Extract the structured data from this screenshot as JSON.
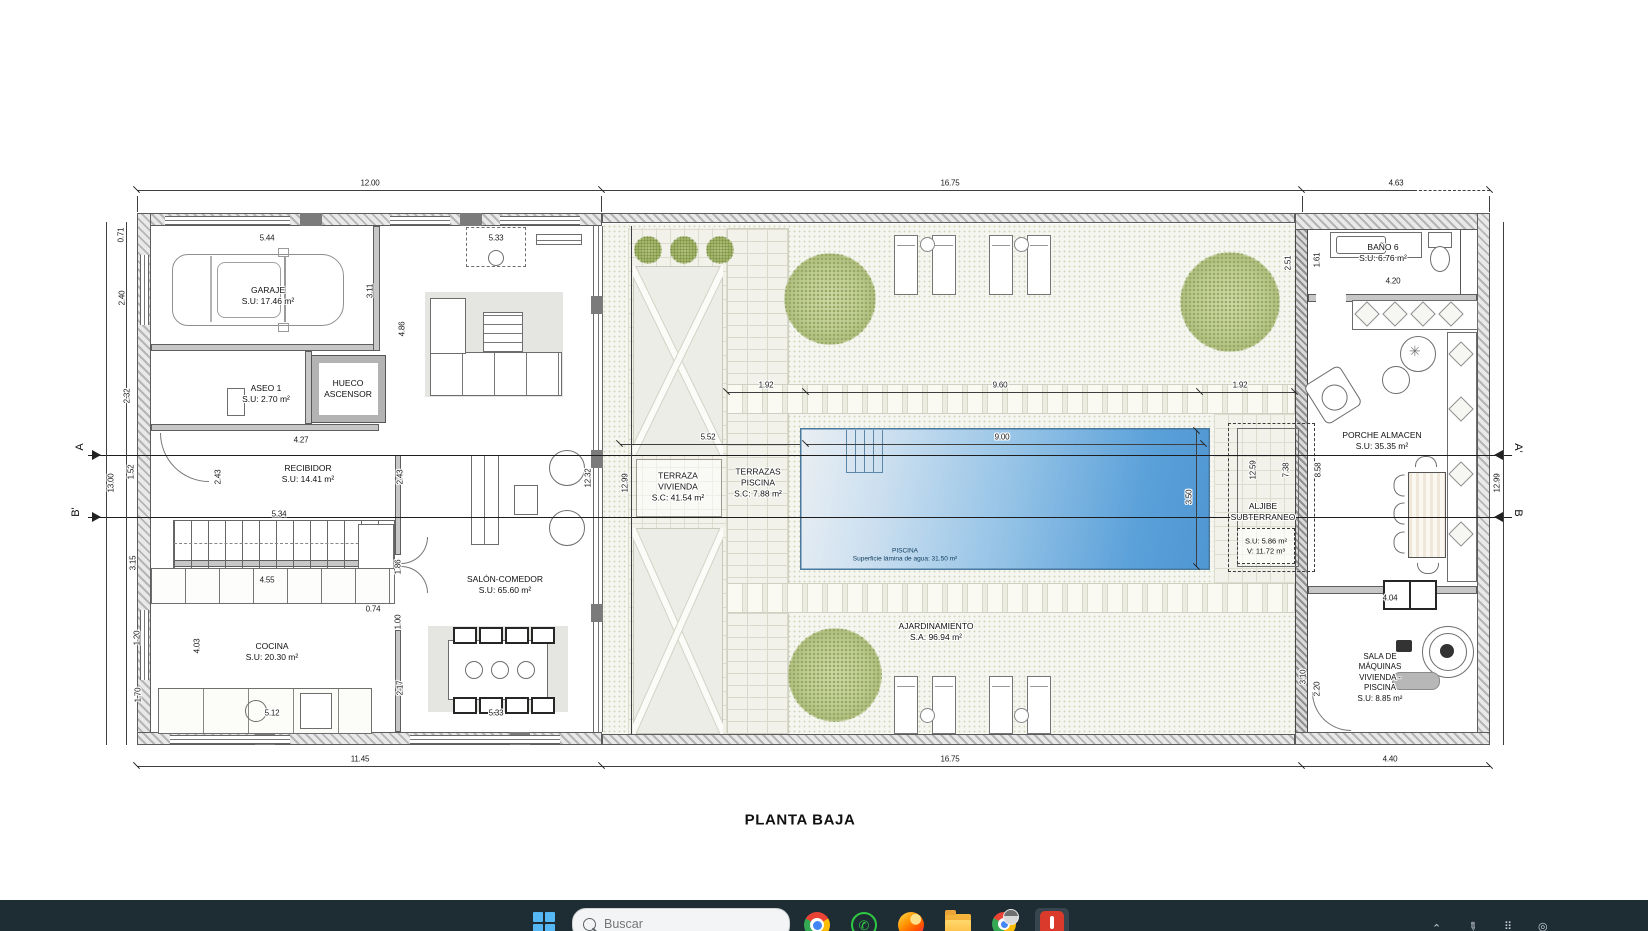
{
  "title": "PLANTA BAJA",
  "rooms": {
    "garaje": {
      "l1": "GARAJE",
      "l2": "S.U: 17.46 m²"
    },
    "aseo": {
      "l1": "ASEO 1",
      "l2": "S.U: 2.70 m²"
    },
    "hueco": {
      "l1": "HUECO",
      "l2": "ASCENSOR"
    },
    "recibidor": {
      "l1": "RECIBIDOR",
      "l2": "S.U: 14.41 m²"
    },
    "salon": {
      "l1": "SALÓN-COMEDOR",
      "l2": "S.U: 65.60 m²"
    },
    "cocina": {
      "l1": "COCINA",
      "l2": "S.U: 20.30 m²"
    },
    "terraza_vivienda": {
      "l1": "TERRAZA",
      "l2": "VIVIENDA",
      "l3": "S.C: 41.54 m²"
    },
    "terrazas_piscina": {
      "l1": "TERRAZAS",
      "l2": "PISCINA",
      "l3": "S.C: 7.88 m²"
    },
    "piscina": {
      "l1": "PISCINA",
      "l2": "Superficie lámina de agua: 31.50 m²"
    },
    "ajardinamiento": {
      "l1": "AJARDINAMIENTO",
      "l2": "S.A: 96.94 m²"
    },
    "bano6": {
      "l1": "BAÑO 6",
      "l2": "S.U: 6.76 m²"
    },
    "porche": {
      "l1": "PORCHE ALMACEN",
      "l2": "S.U: 35.35 m²"
    },
    "aljibe": {
      "l1": "ALJIBE",
      "l2": "SUBTERRANEO",
      "l3": "S.U: 5.86 m²",
      "l4": "V: 11.72 m³"
    },
    "sala_maquinas": {
      "l1": "SALA DE",
      "l2": "MÁQUINAS",
      "l3": "VIVIENDA -",
      "l4": "PISCINA",
      "l5": "S.U: 8.85 m²"
    }
  },
  "dims": {
    "top_house": "12.00",
    "top_garden": "16.75",
    "top_right": "4.63",
    "bot_house": "11.45",
    "bot_garden": "16.75",
    "bot_right": "4.40",
    "g_544": "5.44",
    "g_533t": "5.33",
    "g_311": "3.11",
    "g_486": "4.86",
    "l_071": "0.71",
    "l_240": "2.40",
    "l_232": "2.32",
    "l_152": "1.52",
    "l_1300": "13.00",
    "l_315": "3.15",
    "l_120": "1.20",
    "l_170": "1.70",
    "r_427": "4.27",
    "r_243a": "2.43",
    "r_243b": "2.43",
    "s_534": "5.34",
    "s_455": "4.55",
    "s_074": "0.74",
    "sal_1232": "12.32",
    "sal_186": "1.86",
    "sal_100": "1.00",
    "sal_217": "2.17",
    "sal_533b": "5.33",
    "c_512": "5.12",
    "c_403": "4.03",
    "gd_1299l": "12.99",
    "gd_192a": "1.92",
    "gd_960": "9.60",
    "gd_192b": "1.92",
    "gd_552": "5.52",
    "gd_900": "9.00",
    "gd_350": "3.50",
    "rb_251": "2.51",
    "rb_161": "1.61",
    "rb_420": "4.20",
    "rb_1259": "12.59",
    "rb_738": "7.38",
    "rb_858": "8.58",
    "rb_404": "4.04",
    "rb_310": "3.10",
    "rb_220": "2.20",
    "rb_1299r": "12.99"
  },
  "sections": {
    "a": "A",
    "a_prime": "A'",
    "b": "B",
    "b_prime": "B'"
  },
  "taskbar": {
    "search_placeholder": "Buscar",
    "icons": [
      "windows-start",
      "search",
      "chrome",
      "whatsapp",
      "firefox",
      "file-explorer",
      "chrome-profile",
      "red-app"
    ],
    "tray_icons": [
      "tray-chevron",
      "tray-pen",
      "tray-grid",
      "tray-language"
    ]
  },
  "colors": {
    "pool_blue": "#4f97d3",
    "taskbar_bg": "#1e2c34",
    "accent_windows_blue": "#55b7f3",
    "whatsapp_green": "#30c944",
    "folder_yellow": "#f5b73d",
    "red_app": "#da3a2b",
    "garden_speckle": "#f5f6ef",
    "wall_gray": "#b5b5b5"
  }
}
